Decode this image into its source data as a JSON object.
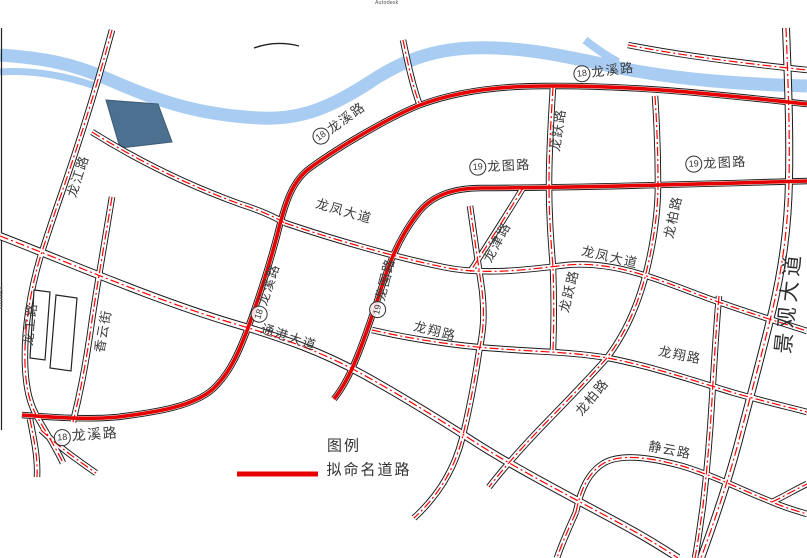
{
  "map": {
    "colors": {
      "river": "#A9CDF2",
      "pond": "#4C7090",
      "road_centerline": "#FF0000",
      "proposed_road": "#E60000",
      "road_casing": "#1A1A1A"
    },
    "badges": {
      "b18": "18",
      "b19": "19"
    },
    "road_names": {
      "longxi": "龙溪路",
      "longtu": "龙图路",
      "longfeng": "龙凤大道",
      "tonggang": "通港大道",
      "longjiang": "龙江路",
      "longgong": "龙工路",
      "xiangyun": "香云街",
      "longjin": "龙津路",
      "longyue": "龙跃路",
      "longbai": "龙柏路",
      "longxiang": "龙翔路",
      "jingyun": "静云路",
      "jingguan": "景观大道"
    },
    "legend": {
      "title": "图例",
      "proposed_label": "拟命名道路"
    },
    "watermark": "Autodesk"
  }
}
